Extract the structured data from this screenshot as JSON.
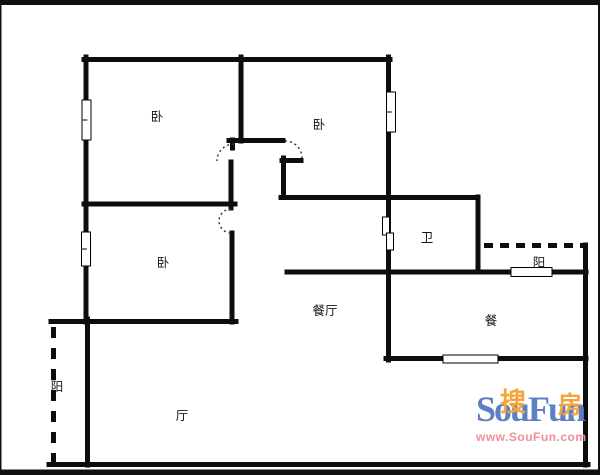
{
  "frame": {
    "color": "#101010",
    "top_bar": [
      0,
      0,
      600,
      5
    ],
    "bottom_bar": [
      0,
      469.5,
      600,
      5.5
    ],
    "left_bar": [
      0,
      0,
      1.5,
      475
    ],
    "right_bar": [
      598,
      0,
      2,
      475
    ]
  },
  "plan": {
    "wall_color": "#0d0d0d",
    "wall_width": 5,
    "walls": [
      [
        84,
        59.5,
        390,
        59.5
      ],
      [
        86,
        57,
        86,
        322
      ],
      [
        87.5,
        319,
        87.5,
        465
      ],
      [
        241,
        57,
        241,
        141
      ],
      [
        229,
        140.5,
        283,
        140.5
      ],
      [
        232.5,
        140,
        232.5,
        148
      ],
      [
        231,
        162,
        231,
        208
      ],
      [
        84,
        204,
        235,
        204
      ],
      [
        232,
        233,
        232,
        322
      ],
      [
        51,
        321.5,
        236,
        321.5
      ],
      [
        49,
        464.5,
        588,
        464.5
      ],
      [
        585.5,
        245,
        585.5,
        465
      ],
      [
        388.5,
        57,
        388.5,
        360
      ],
      [
        282,
        160.5,
        301,
        160.5
      ],
      [
        283.5,
        158,
        283.5,
        197
      ],
      [
        281,
        197.5,
        478,
        197.5
      ],
      [
        478,
        197,
        478,
        272
      ],
      [
        287,
        272,
        586,
        272
      ],
      [
        386,
        358.5,
        586,
        358.5
      ]
    ],
    "balcony_edges": [
      {
        "x1": 53.5,
        "y1": 327,
        "x2": 53.5,
        "y2": 462,
        "dash": "11 10"
      },
      {
        "x1": 484,
        "y1": 245.5,
        "x2": 583,
        "y2": 245.5,
        "dash": "9 7"
      }
    ],
    "windows": [
      {
        "x": 82,
        "y": 100,
        "w": 9,
        "h": 40,
        "mid": true
      },
      {
        "x": 81.5,
        "y": 232,
        "w": 9,
        "h": 34,
        "mid": true
      },
      {
        "x": 386.5,
        "y": 92,
        "w": 9,
        "h": 40,
        "mid": true
      },
      {
        "x": 511,
        "y": 267.5,
        "w": 41,
        "h": 9,
        "mid": false
      },
      {
        "x": 443,
        "y": 355,
        "w": 55,
        "h": 8,
        "mid": false
      }
    ],
    "sliding_door": [
      {
        "x": 382.5,
        "y": 217,
        "w": 7,
        "h": 18
      },
      {
        "x": 386.5,
        "y": 233,
        "w": 7,
        "h": 17
      }
    ],
    "door_arcs": [
      "M 234 144 A 17 17 0 0 0 217 161",
      "M 285 141 A 17 17 0 0 1 302 158",
      "M 231 209 A 12 12 0 0 0 231 233"
    ],
    "label_color": "#161616",
    "label_size": 12.5
  },
  "rooms": [
    {
      "id": "bedroom-top-left",
      "label": "卧",
      "x": 157,
      "y": 116
    },
    {
      "id": "bedroom-top-right",
      "label": "卧",
      "x": 319,
      "y": 124
    },
    {
      "id": "bedroom-mid-left",
      "label": "卧",
      "x": 163,
      "y": 262
    },
    {
      "id": "bathroom",
      "label": "卫",
      "x": 427,
      "y": 237
    },
    {
      "id": "balcony-right",
      "label": "阳",
      "x": 539,
      "y": 262
    },
    {
      "id": "dining-hall",
      "label": "餐厅",
      "x": 325,
      "y": 310
    },
    {
      "id": "dining-room",
      "label": "餐",
      "x": 491,
      "y": 320
    },
    {
      "id": "living-hall",
      "label": "厅",
      "x": 182,
      "y": 415
    },
    {
      "id": "balcony-left",
      "label": "阳",
      "x": 57,
      "y": 386
    }
  ],
  "watermark": {
    "hanzi_left": "搜",
    "hanzi_right": "房",
    "brand": "SouFun",
    "url": "www.SouFun.com",
    "brand_color": "#5c7fc5",
    "hanzi_color": "#f4a63c",
    "url_color": "#f18f99"
  }
}
